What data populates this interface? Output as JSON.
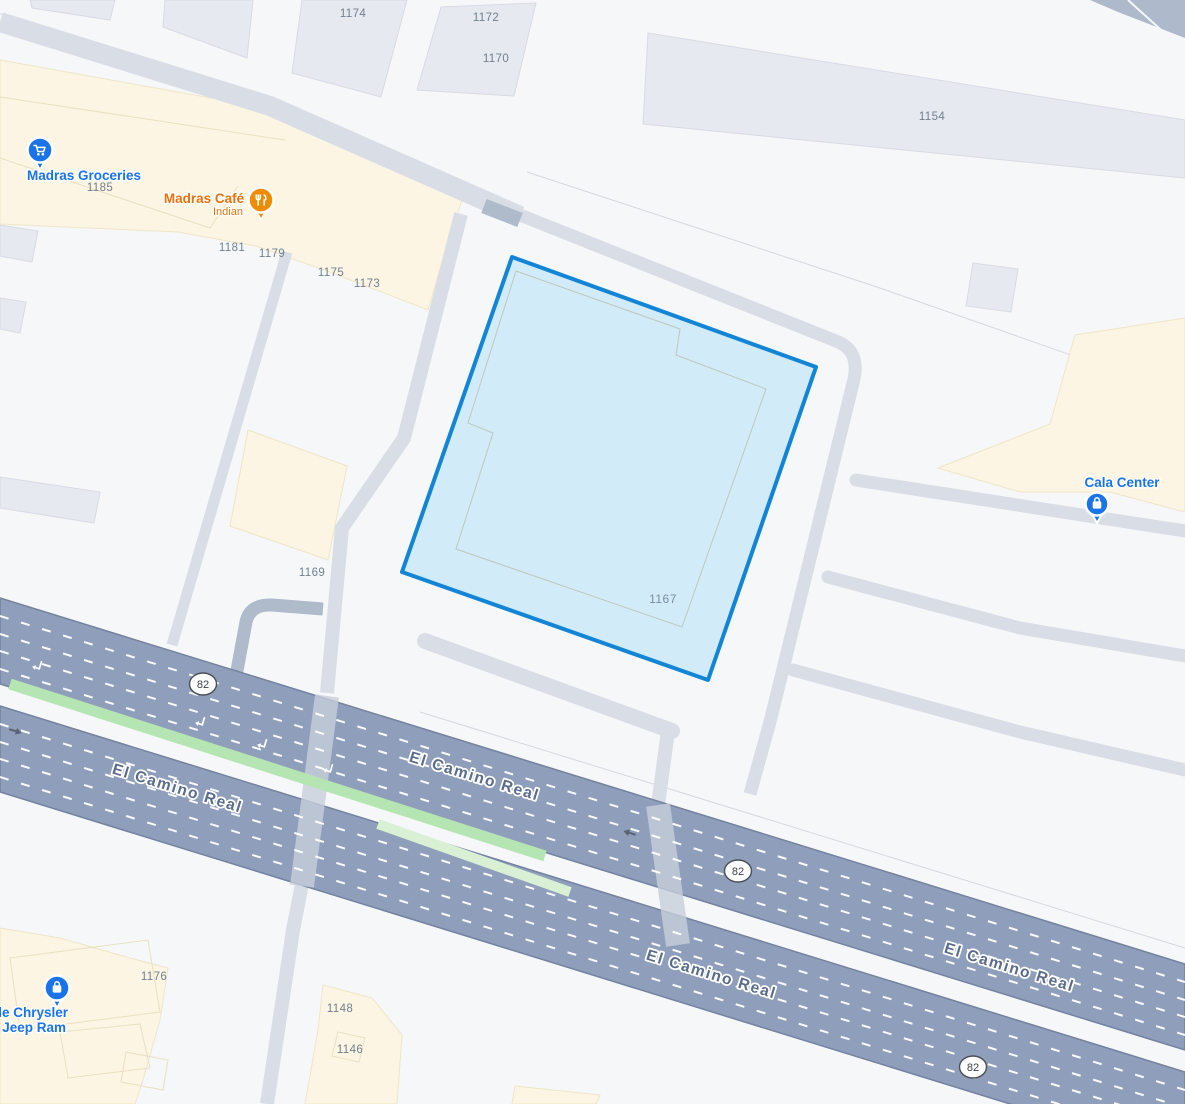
{
  "map": {
    "road": {
      "name": "El Camino Real",
      "labels": [
        "El Camino Real",
        "El Camino Real",
        "El Camino Real",
        "El Camino Real"
      ],
      "route_shields": [
        "82",
        "82",
        "82"
      ]
    },
    "selected_parcel": {
      "number": "1167",
      "fill_color": "#CDE9F8",
      "border_color": "#1385D6"
    },
    "pois": [
      {
        "name": "Madras Groceries",
        "icon": "shopping-cart-pin",
        "color": "#1A73E8"
      },
      {
        "name": "Madras Café",
        "subtitle": "Indian",
        "icon": "restaurant-pin",
        "color": "#EE8C00"
      },
      {
        "name": "Cala Center",
        "icon": "shopping-bag-pin",
        "color": "#1A73E8"
      },
      {
        "name_line1": "ale Chrysler",
        "name_line2": "e Jeep Ram",
        "icon": "shopping-bag-pin",
        "color": "#1A73E8"
      }
    ],
    "building_numbers": [
      "1174",
      "1172",
      "1170",
      "1154",
      "1185",
      "1181",
      "1179",
      "1175",
      "1173",
      "1169",
      "1176",
      "1148",
      "1146",
      "11"
    ],
    "colors": {
      "background": "#F6F7F9",
      "building": "#E6E9EF",
      "commercial_area": "#FCF5E3",
      "local_road": "#D9DDE6",
      "highway": "#8F9FBB",
      "median_green": "#B5E5B2",
      "poi_blue": "#1A73E8",
      "poi_orange": "#E8710A"
    }
  }
}
